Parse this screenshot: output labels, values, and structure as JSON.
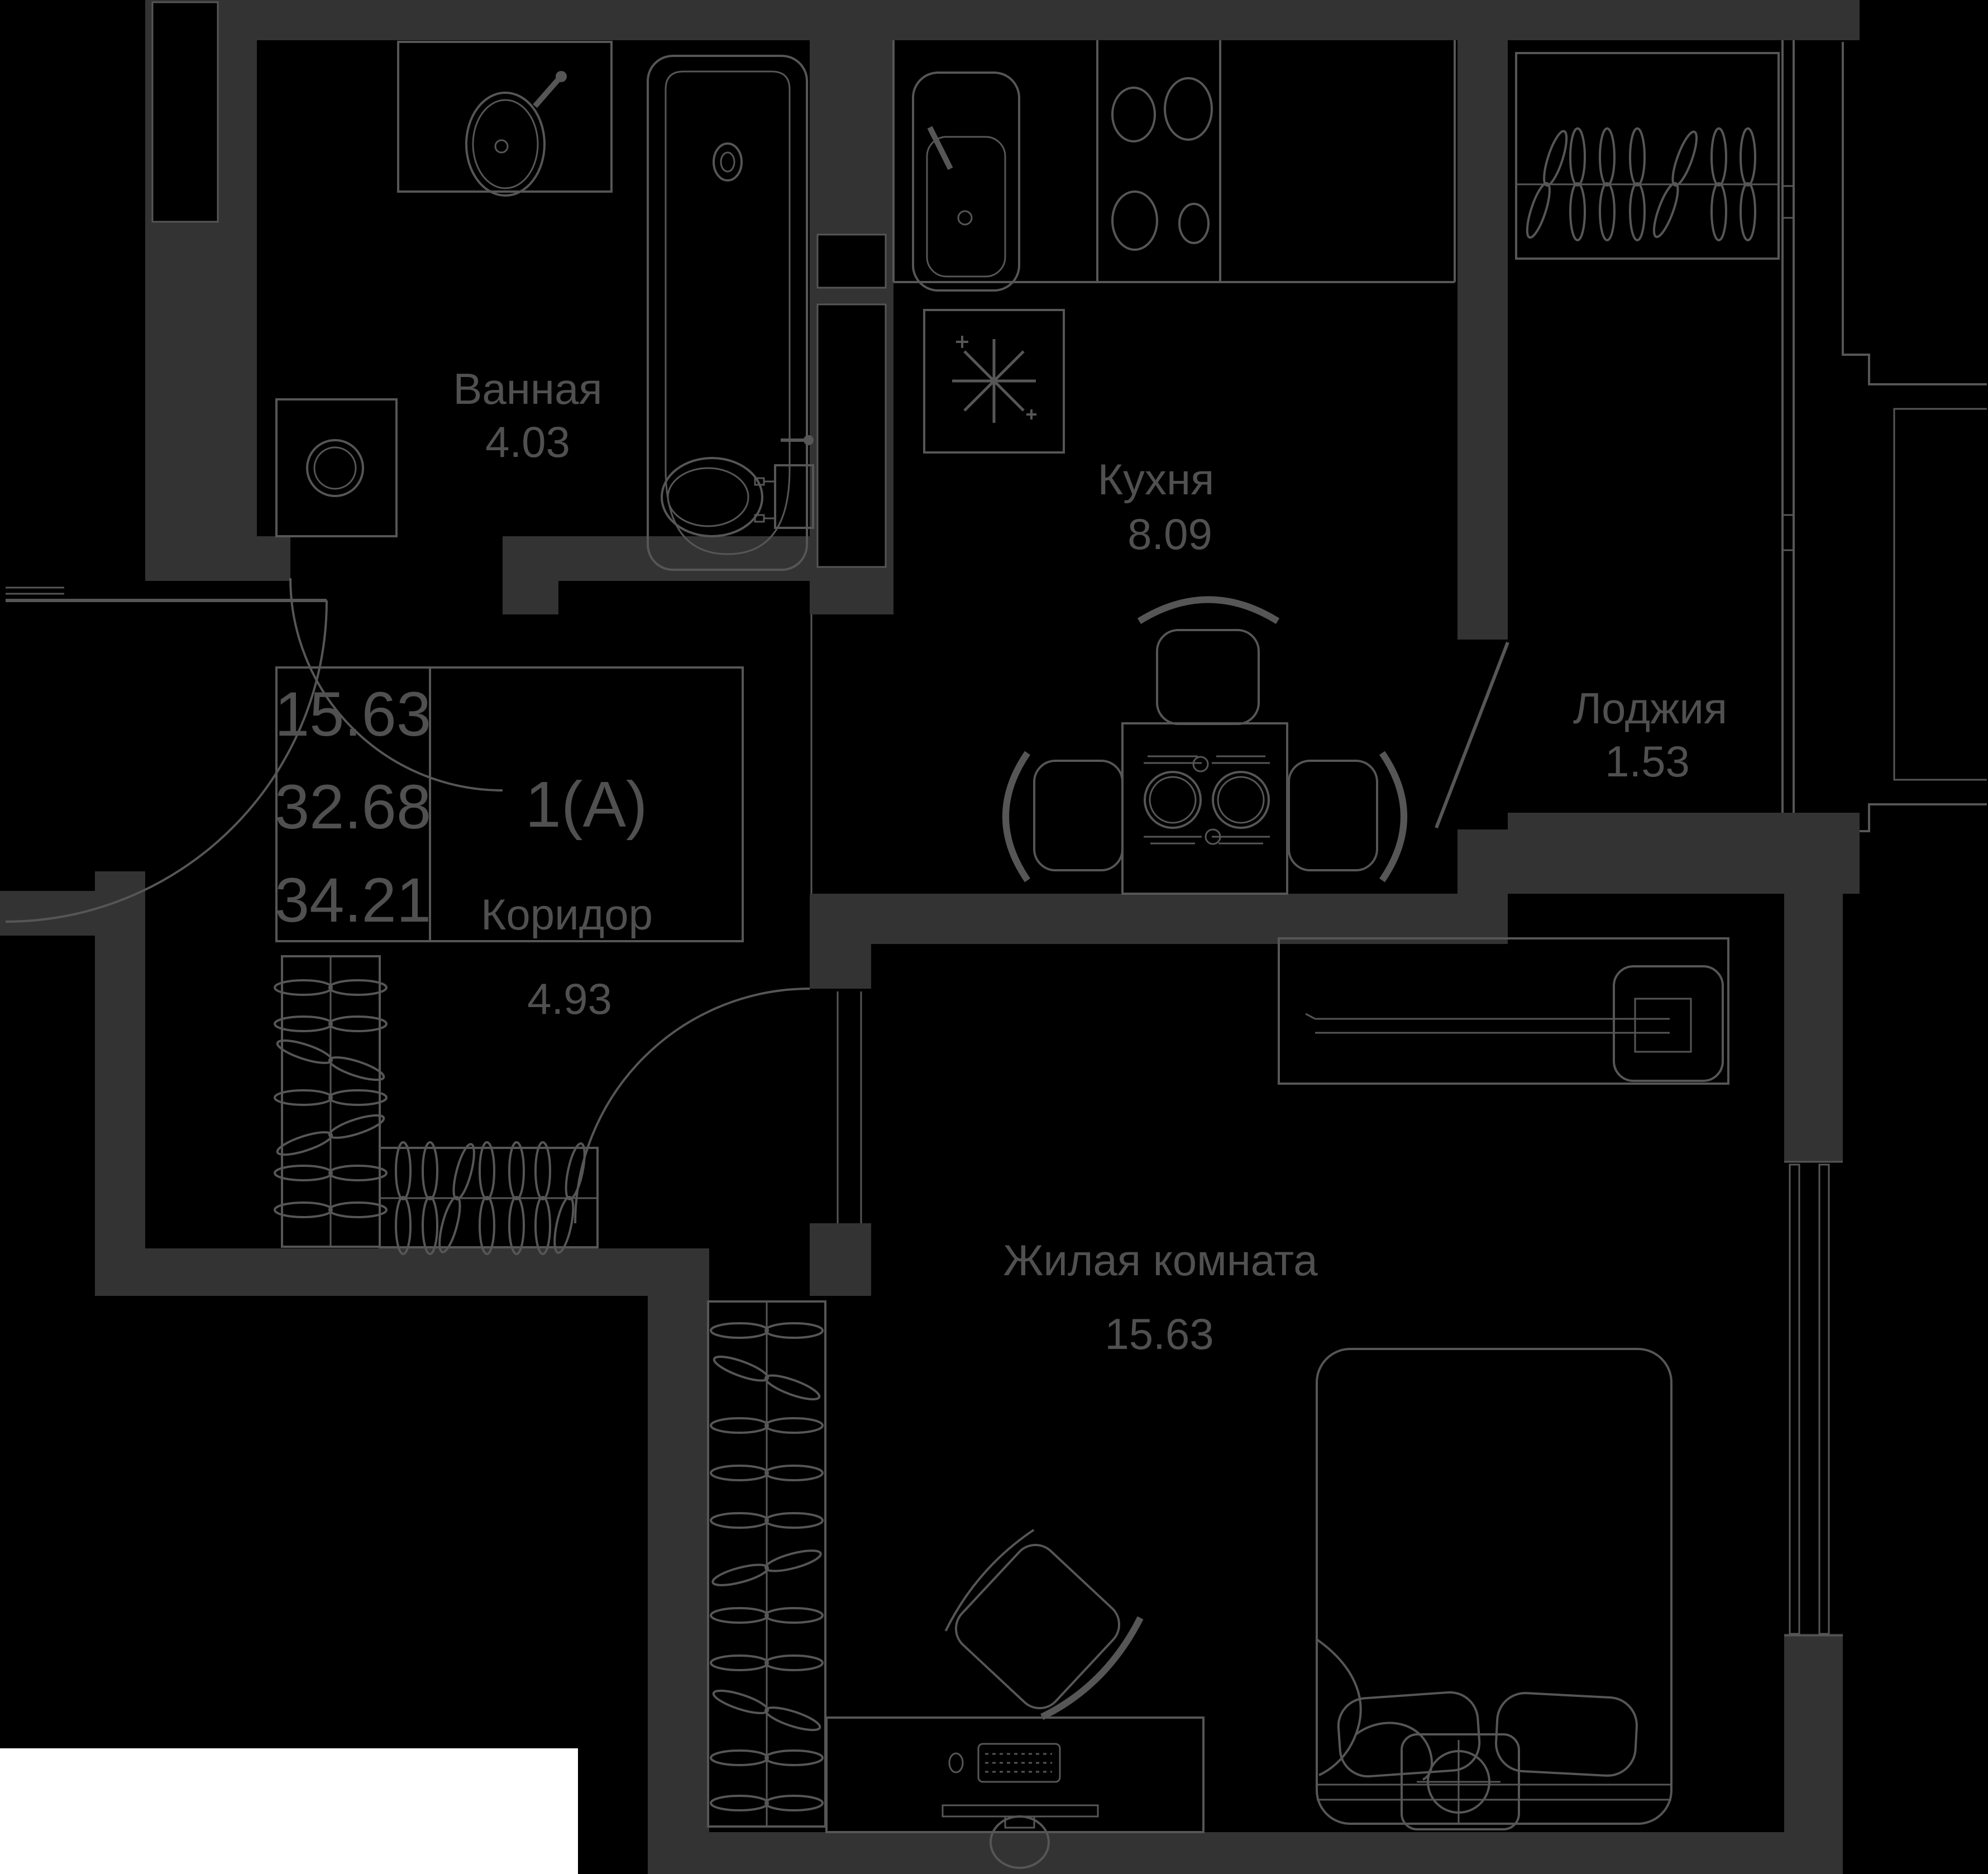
{
  "plan": {
    "unit": {
      "type_label": "1(А)",
      "living_area": "15.63",
      "apartment_area": "32.68",
      "total_area": "34.21"
    },
    "rooms": [
      {
        "name": "Ванная",
        "area": "4.03"
      },
      {
        "name": "Кухня",
        "area": "8.09"
      },
      {
        "name": "Лоджия",
        "area": "1.53"
      },
      {
        "name": "Коридор",
        "area": "4.93"
      },
      {
        "name": "Жилая комната",
        "area": "15.63"
      }
    ],
    "colors": {
      "background": "#000000",
      "wall": "#333333",
      "line": "#565656",
      "text": "#505050",
      "corner_block": "#ffffff"
    }
  }
}
